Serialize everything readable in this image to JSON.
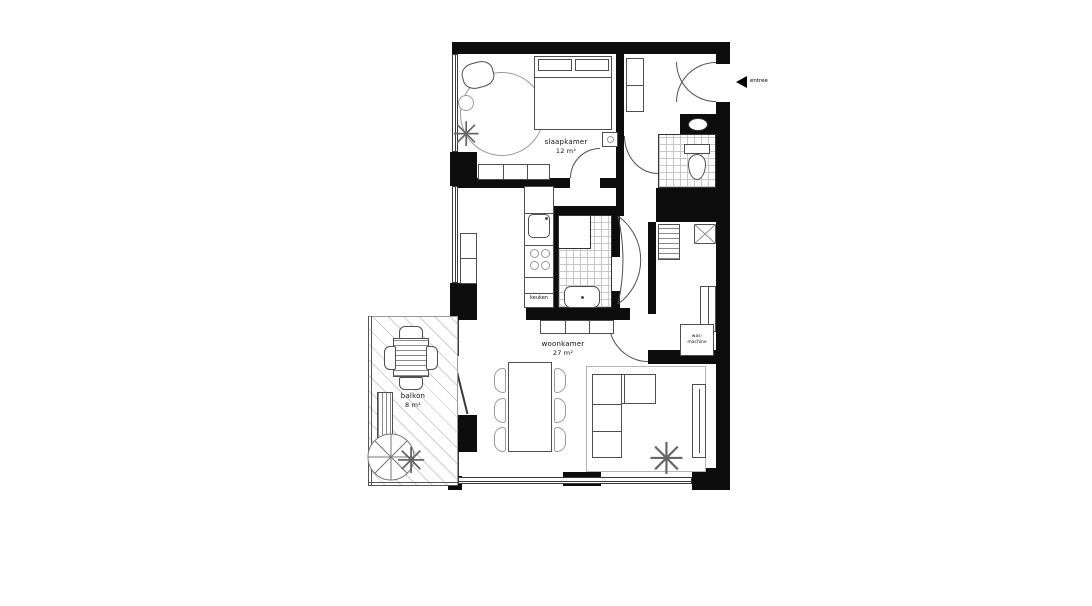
{
  "plan": {
    "rooms": {
      "bedroom": {
        "label": "slaapkamer",
        "area": "12 m²"
      },
      "living": {
        "label": "woonkamer",
        "area": "27 m²"
      },
      "balcony": {
        "label": "balkon",
        "area": "8 m²"
      },
      "kitchen": {
        "label": "keuken"
      }
    },
    "fixtures": {
      "washer": {
        "line1": "was-",
        "line2": "machine"
      }
    },
    "entrance": {
      "label": "entree"
    },
    "icons": {
      "plant": "✳",
      "entrance_arrow": "left-arrow"
    },
    "colors": {
      "wall": "#0d0d0d",
      "outline": "#4f4f4f",
      "tile": "#c7c7c7",
      "background": "#ffffff"
    }
  }
}
